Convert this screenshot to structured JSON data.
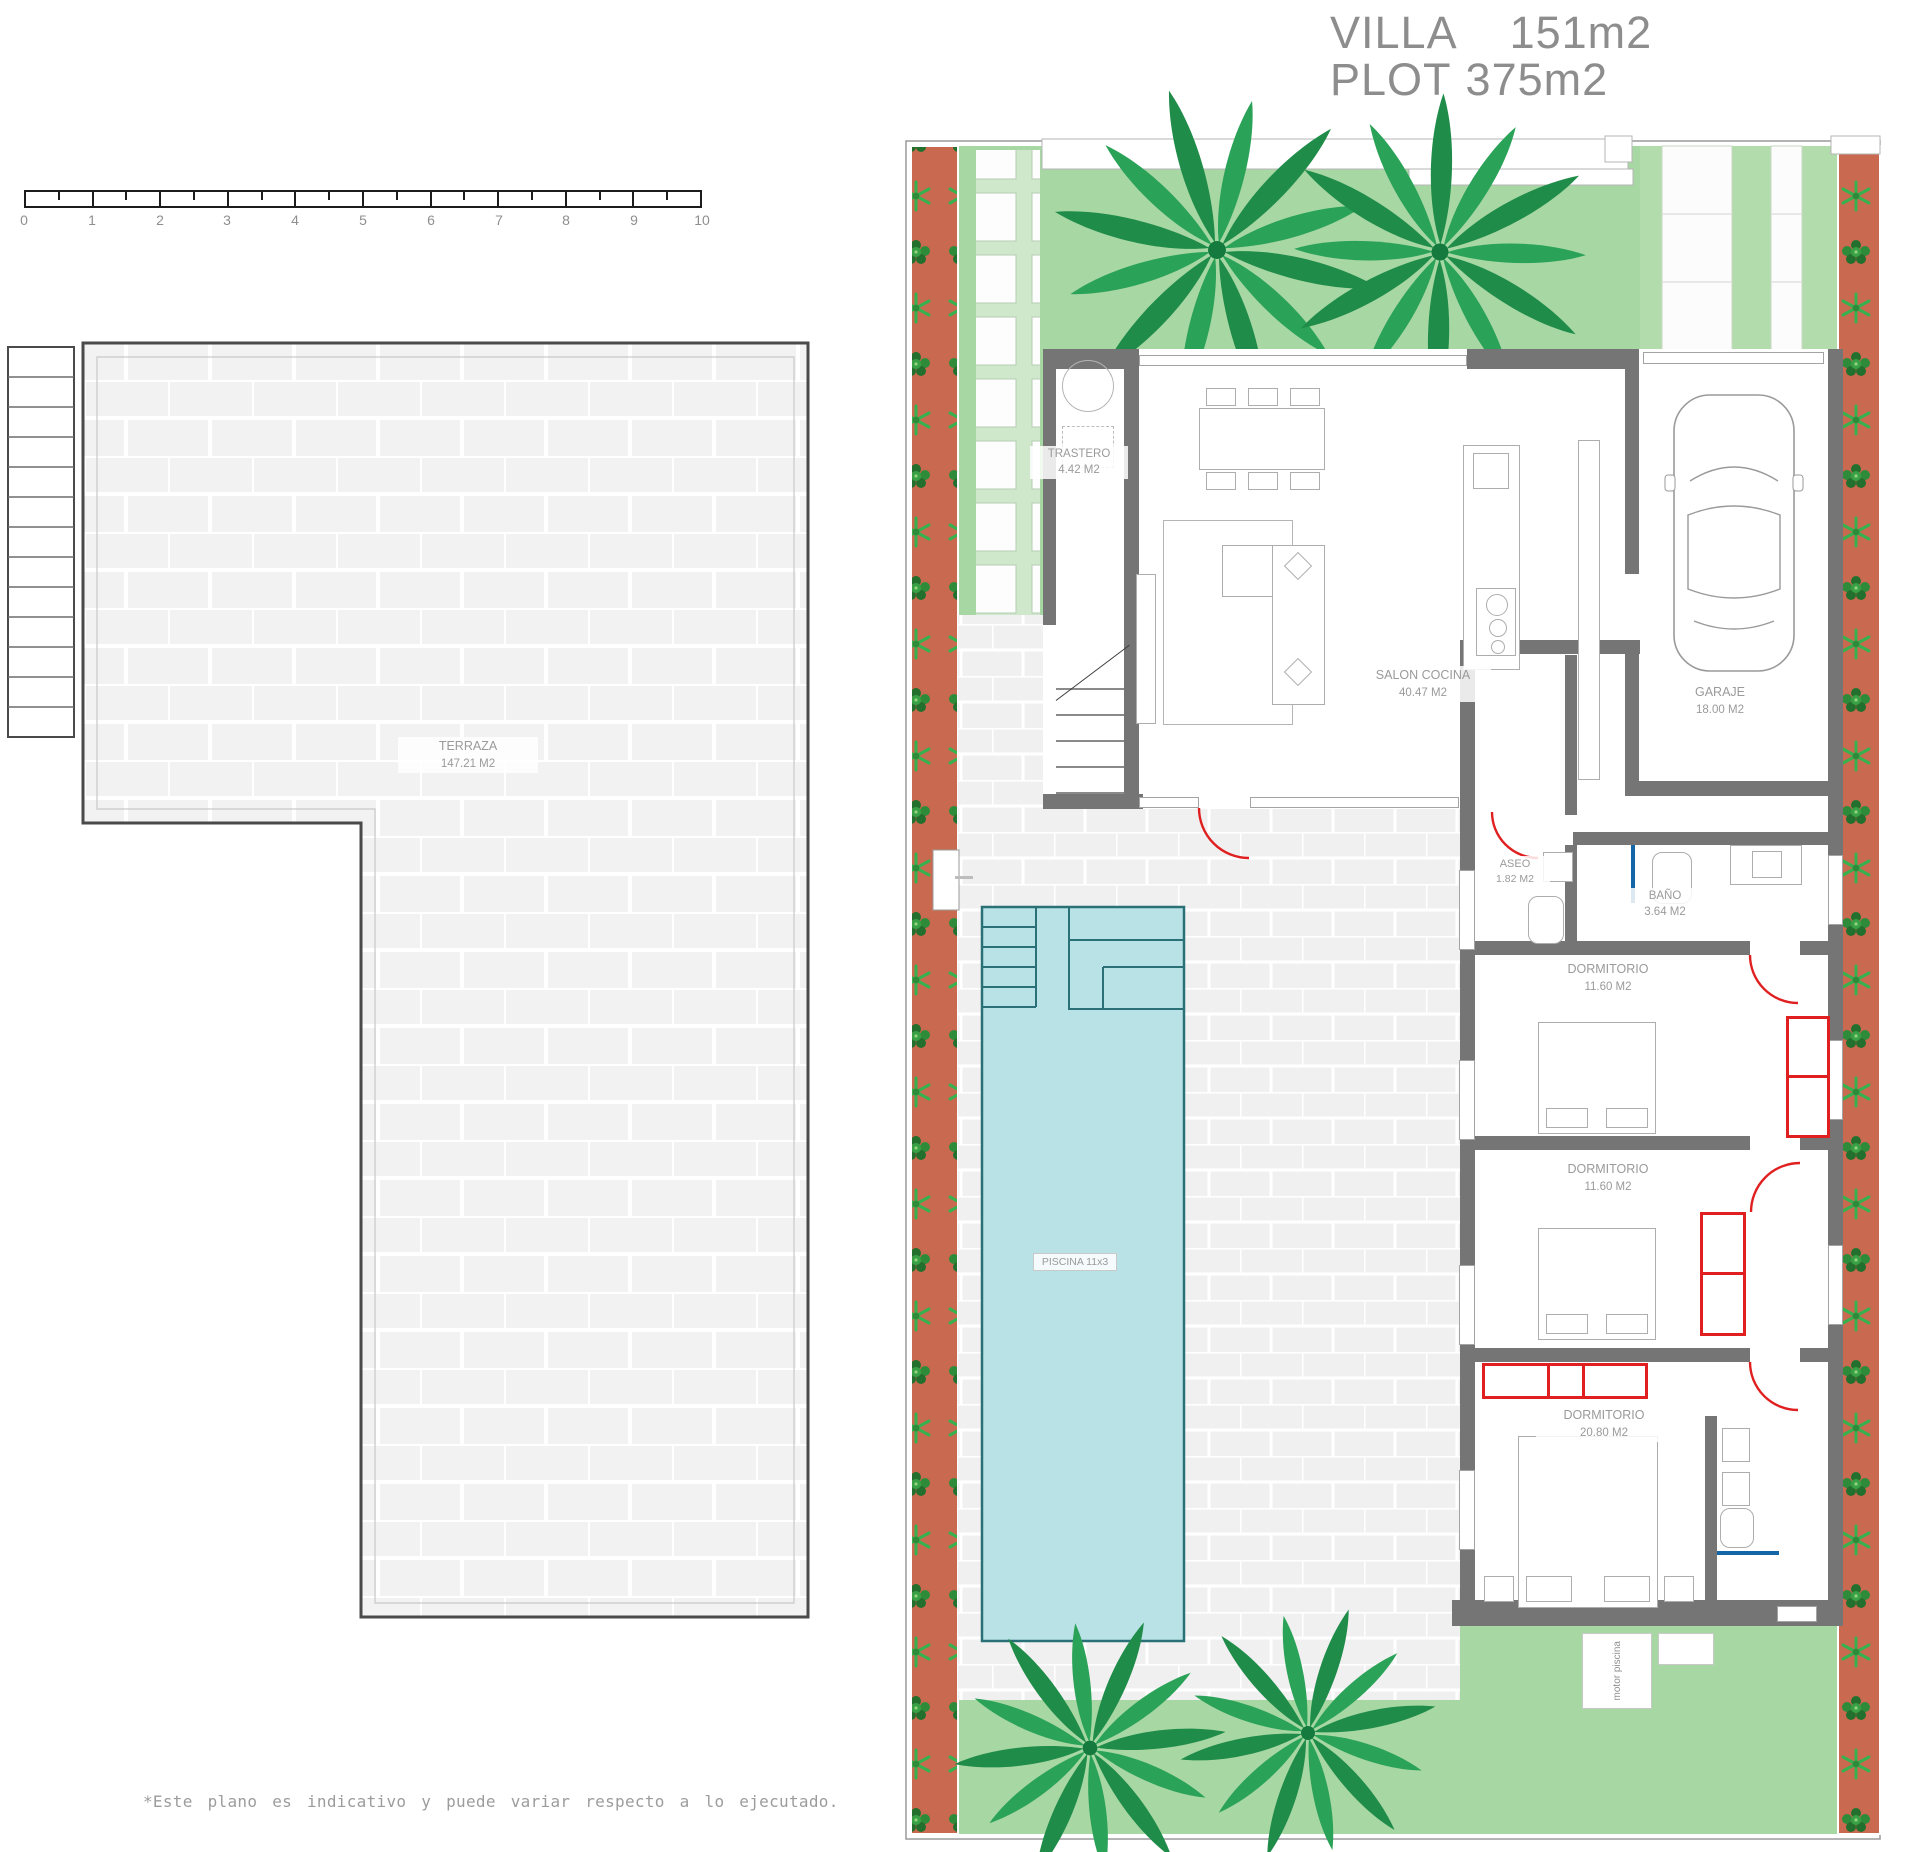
{
  "title": {
    "villa_label": "VILLA",
    "villa_value": "151m2",
    "plot_label": "PLOT",
    "plot_value": "375m2"
  },
  "scale_ruler": {
    "numbers": [
      "0",
      "1",
      "2",
      "3",
      "4",
      "5",
      "6",
      "7",
      "8",
      "9",
      "10"
    ]
  },
  "terrace_plan": {
    "room": {
      "name": "TERRAZA",
      "area": "147.21 M2"
    }
  },
  "floor_plan": {
    "rooms": {
      "trastero": {
        "name": "TRASTERO",
        "area": "4.42 M2"
      },
      "salon": {
        "name": "SALON COCINA",
        "area": "40.47 M2"
      },
      "garaje": {
        "name": "GARAJE",
        "area": "18.00 M2"
      },
      "aseo": {
        "name": "ASEO",
        "area": "1.82 M2"
      },
      "bano": {
        "name": "BAÑO",
        "area": "3.64 M2"
      },
      "dormitorio1": {
        "name": "DORMITORIO",
        "area": "11.60 M2"
      },
      "dormitorio2": {
        "name": "DORMITORIO",
        "area": "11.60 M2"
      },
      "dormitorio3": {
        "name": "DORMITORIO",
        "area": "20.80 M2"
      },
      "piscina": {
        "label": "PISCINA 11x3"
      },
      "motor": {
        "label": "motor piscina"
      }
    }
  },
  "disclaimer": {
    "line1": "*Este plano es indicativo y puede variar respecto a lo ejecutado.",
    "line2": "*This plan is indicative and may change with respect to the execution."
  },
  "colors": {
    "lawn_green": "#a7d7a3",
    "lawn_pale": "#cfe7cb",
    "hedge_red": "#c96a50",
    "bush_green": "#2e8b3a",
    "bush_dark": "#236f2d",
    "palm_green": "#2aa257",
    "pool_fill": "#b9e2e6",
    "pool_stroke": "#2a7077",
    "wall_grey": "#757575",
    "brick_fill": "#f1f1f1",
    "brick_joint": "#ffffff",
    "accent_red": "#e02020",
    "accent_blue": "#1566a6",
    "label_grey": "#9a9a9a",
    "title_grey": "#8d8d8d"
  }
}
